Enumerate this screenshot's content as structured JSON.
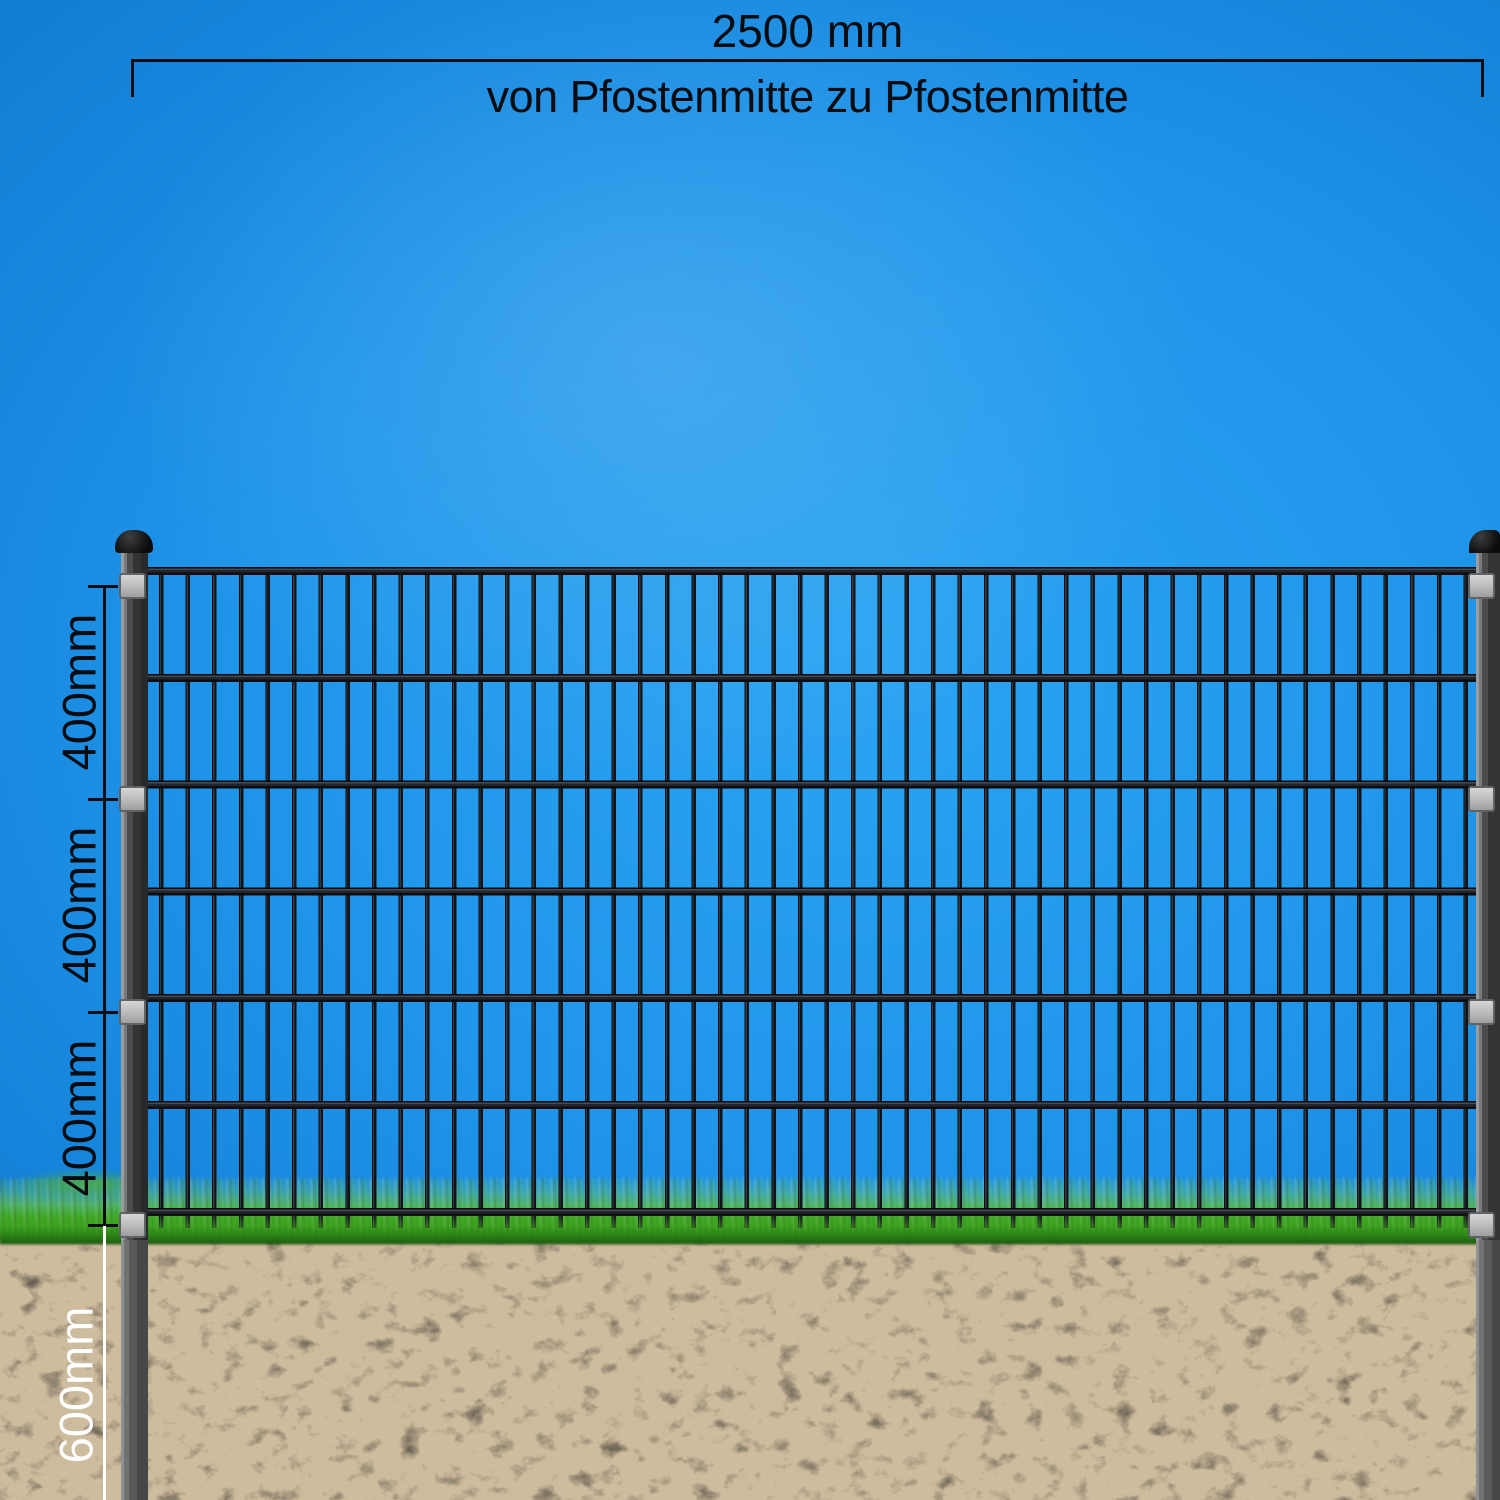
{
  "illustration": {
    "subject": "double-rod mesh fence panel with two posts, shown above and below ground",
    "top_dimension": {
      "value": "2500 mm",
      "caption": "von Pfostenmitte zu Pfostenmitte"
    },
    "side_dimensions": {
      "sections": [
        {
          "label": "400mm"
        },
        {
          "label": "400mm"
        },
        {
          "label": "400mm"
        }
      ],
      "below_ground": {
        "label": "600mm"
      }
    },
    "fence": {
      "post_count": 2,
      "clamp_bracket_count": 8,
      "horizontal_rail_count": 7,
      "vertical_bar_count": 50
    },
    "colors": {
      "sky_blue": "#1f95ea",
      "grass_green": "#2a8f16",
      "soil_brown": "#50463a",
      "post_gray": "#323436",
      "bracket_gray": "#b9babc",
      "bar_black": "#101317",
      "dimension_black": "#0b0d12",
      "dimension_white": "#ffffff"
    }
  }
}
